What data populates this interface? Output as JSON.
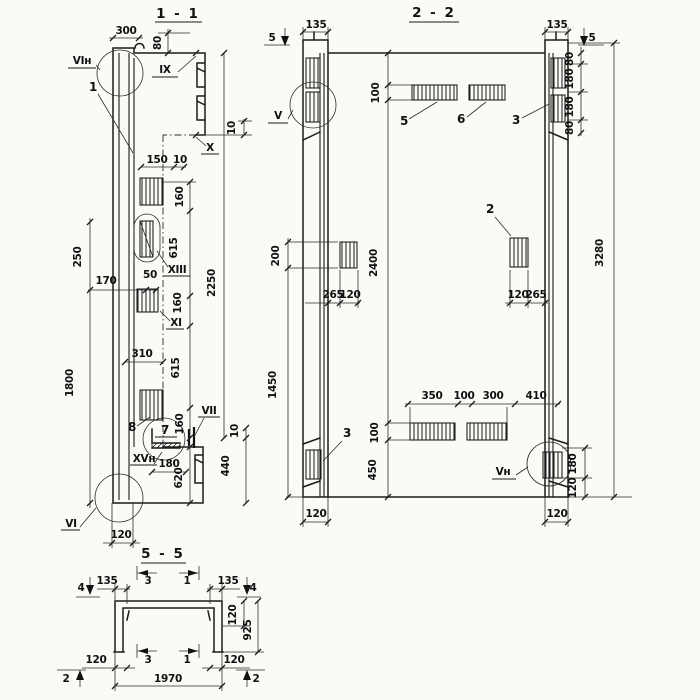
{
  "drawing": {
    "kind": "structural precast panel working drawing, three sections",
    "paper_color": "#fafaf7",
    "ink_color": "#1a1a1a",
    "views": {
      "v11": {
        "title": "1 - 1",
        "part_labels": {
          "p1": "1",
          "p7": "7",
          "p8": "8"
        },
        "node_labels": {
          "vi_n": "VIн",
          "ix": "IX",
          "x": "X",
          "xiii": "XIII",
          "xi": "XI",
          "vii": "VII",
          "xv_n": "XVн",
          "vi": "VI"
        },
        "dims": {
          "d300": "300",
          "d80": "80",
          "d10_top": "10",
          "d150": "150",
          "d10_step": "10",
          "d160_1": "160",
          "d615_1": "615",
          "d160_2": "160",
          "d615_2": "615",
          "d160_3": "160",
          "d2250": "2250",
          "d250": "250",
          "d170": "170",
          "d50": "50",
          "d310": "310",
          "d1800": "1800",
          "d10_bot": "10",
          "d440": "440",
          "d180": "180",
          "d620": "620",
          "d120": "120"
        }
      },
      "v22": {
        "title": "2 - 2",
        "part_labels": {
          "p2": "2",
          "p3_top": "3",
          "p3_bottom": "3",
          "p5": "5",
          "p6": "6"
        },
        "node_labels": {
          "v": "V",
          "v_n": "Vн"
        },
        "section_markers": {
          "m5_left": "5",
          "m5_right": "5"
        },
        "dims": {
          "d135_l": "135",
          "d135_r": "135",
          "d80_1": "80",
          "d180_1": "180",
          "d180_2": "180",
          "d80_2": "80",
          "d100_top": "100",
          "d200": "200",
          "d2400": "2400",
          "d3280": "3280",
          "d265_l": "265",
          "d120_l": "120",
          "d120_r": "120",
          "d265_r": "265",
          "d1450": "1450",
          "d350": "350",
          "d100_mid": "100",
          "d300": "300",
          "d410": "410",
          "d100_bot": "100",
          "d450": "450",
          "d180_b": "180",
          "d120_b": "120",
          "d120_bl": "120",
          "d120_br": "120"
        }
      },
      "v55": {
        "title": "5 - 5",
        "section_markers": {
          "m4_l": "4",
          "m4_r": "4",
          "m3_t": "3",
          "m1_t": "1",
          "m3_b": "3",
          "m1_b": "1",
          "m2_l": "2",
          "m2_r": "2"
        },
        "dims": {
          "d135_l": "135",
          "d135_r": "135",
          "d120_t": "120",
          "d925": "925",
          "d120_bl": "120",
          "d120_br": "120",
          "d1970": "1970"
        }
      }
    }
  }
}
